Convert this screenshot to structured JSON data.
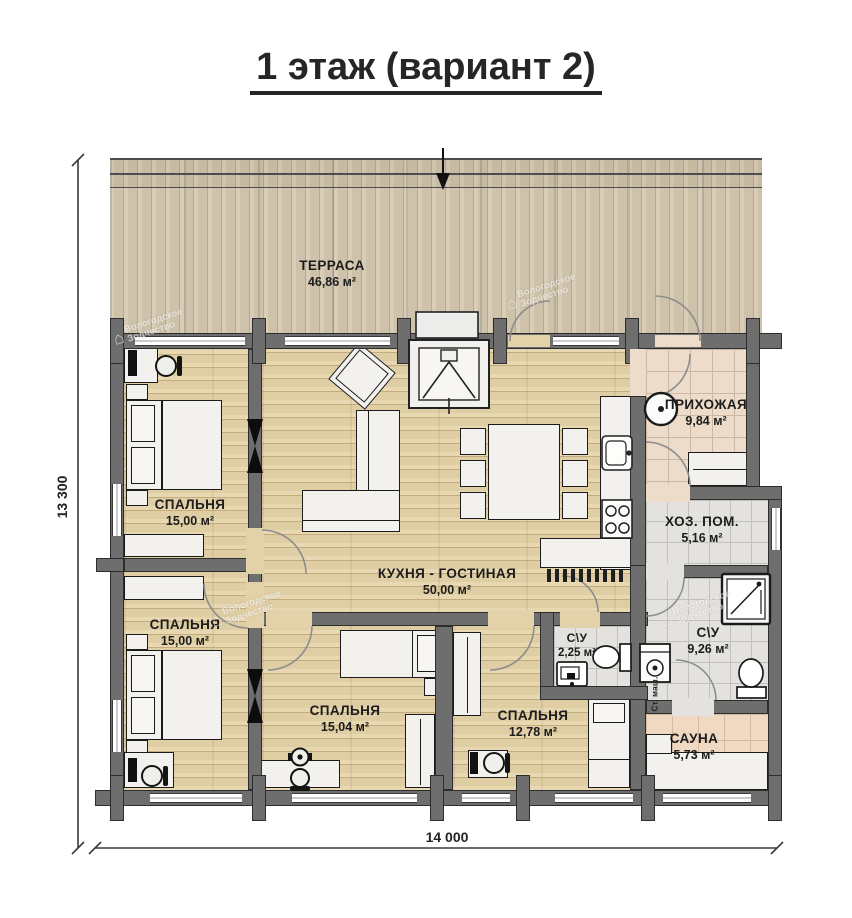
{
  "title": "1 этаж (вариант 2)",
  "rooms": {
    "terrace": {
      "name": "ТЕРРАСА",
      "area": "46,86 м²"
    },
    "bedroom1": {
      "name": "СПАЛЬНЯ",
      "area": "15,00 м²"
    },
    "bedroom2": {
      "name": "СПАЛЬНЯ",
      "area": "15,00 м²"
    },
    "kitchen_living": {
      "name": "КУХНЯ - ГОСТИНАЯ",
      "area": "50,00 м²"
    },
    "hallway": {
      "name": "ПРИХОЖАЯ",
      "area": "9,84 м²"
    },
    "utility": {
      "name": "ХОЗ. ПОМ.",
      "area": "5,16 м²"
    },
    "wc_small": {
      "name": "С\\У",
      "area": "2,25 м²"
    },
    "wc_big": {
      "name": "С\\У",
      "area": "9,26 м²"
    },
    "bedroom3": {
      "name": "СПАЛЬНЯ",
      "area": "15,04 м²"
    },
    "bedroom4": {
      "name": "СПАЛЬНЯ",
      "area": "12,78 м²"
    },
    "sauna": {
      "name": "САУНА",
      "area": "5,73 м²"
    }
  },
  "dimensions": {
    "width": "14 000",
    "height": "13 300"
  },
  "appliances": {
    "washer": "Ст. маш."
  },
  "watermark": {
    "line1": "Вологодское",
    "line2": "Зодчество",
    "logo": "⌂"
  },
  "colors": {
    "wall": "#6e6e6e",
    "wood": "#e4d3aa",
    "terrace": "#d5c9b4",
    "tile_pink": "#eddcca",
    "tile_gray": "#e4e2de",
    "ink": "#1c1c1c"
  }
}
